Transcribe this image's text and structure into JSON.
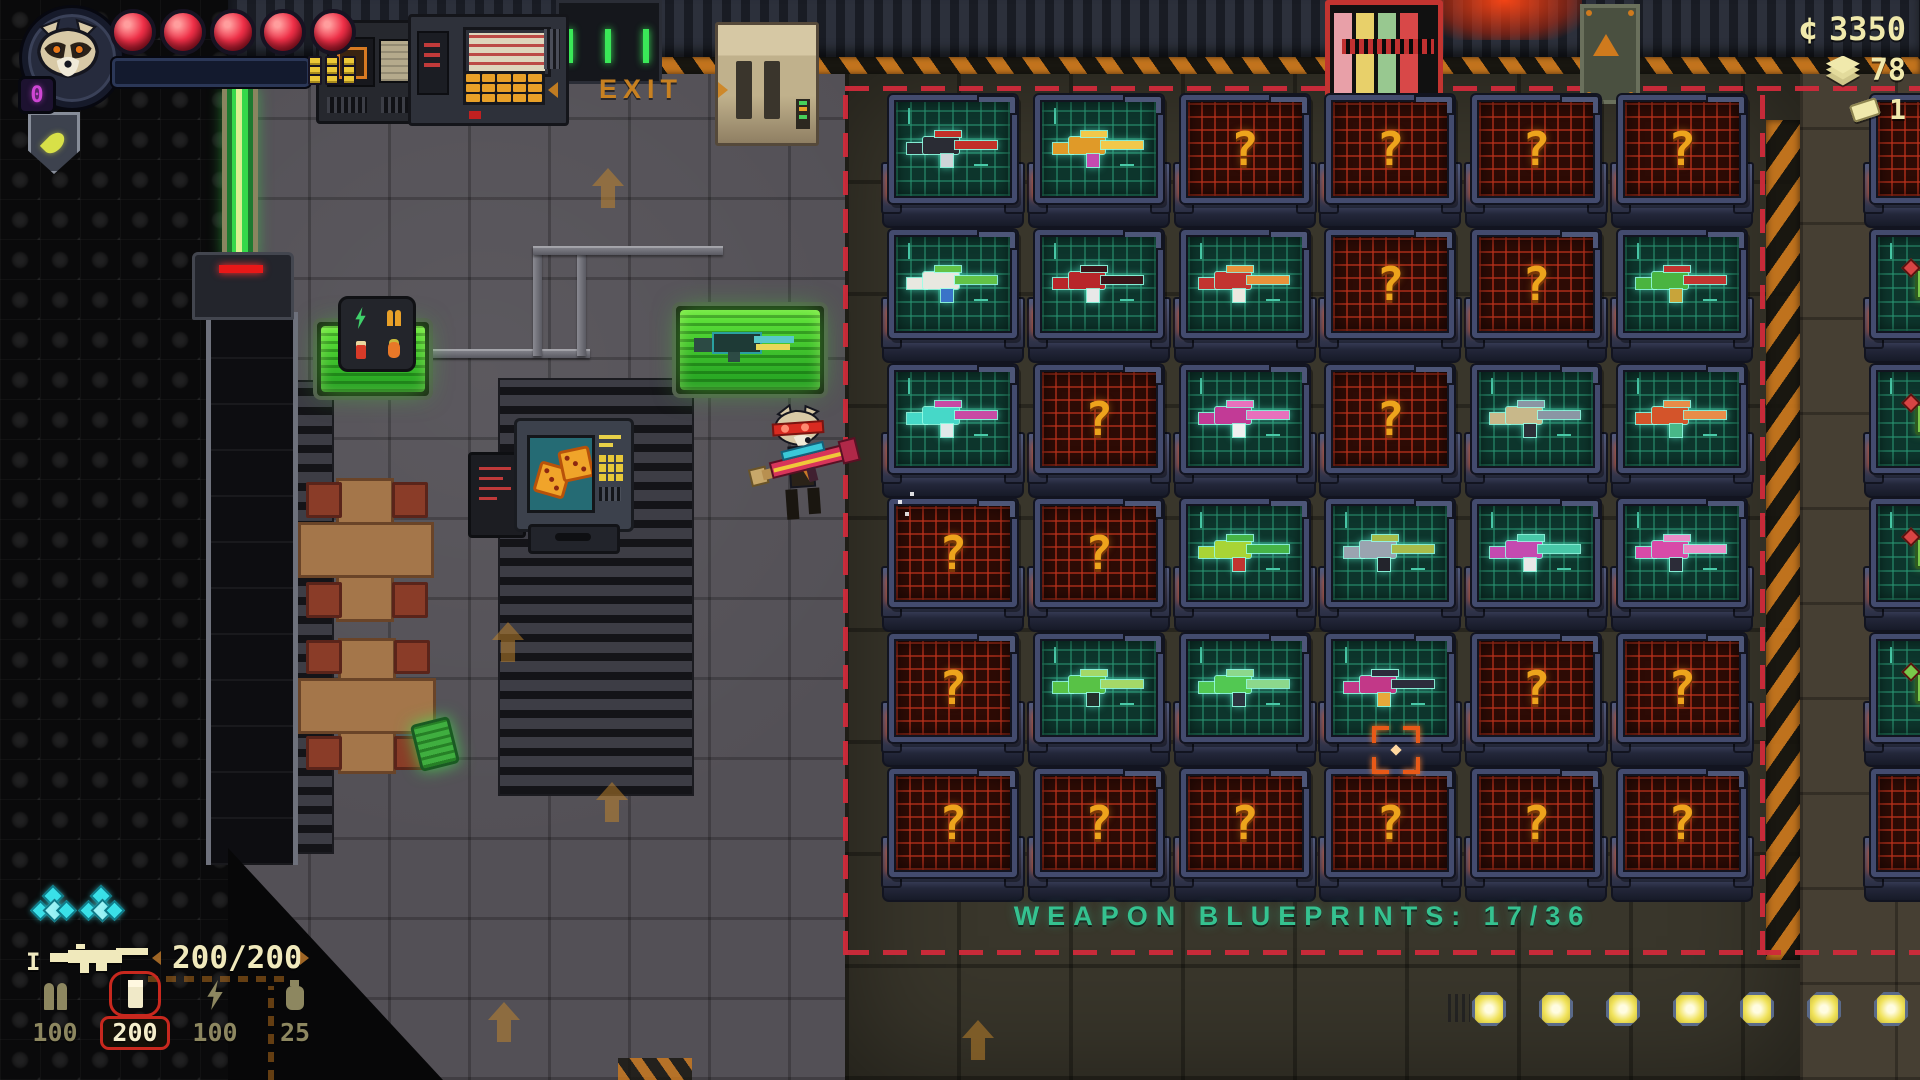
{
  "currencies": [
    {
      "name": "credits",
      "symbol": "¢",
      "value": "3350"
    },
    {
      "name": "materials",
      "value": "78"
    },
    {
      "name": "tickets",
      "value": "1"
    }
  ],
  "hud": {
    "level": "0",
    "health_orbs": 5,
    "xp_segment_columns": 3,
    "gem_count": 2,
    "weapon_tier": "I",
    "ammo": "200/200",
    "ammo_slots": [
      {
        "type": "bullets",
        "value": "100",
        "selected": false
      },
      {
        "type": "shells",
        "value": "200",
        "selected": true
      },
      {
        "type": "energy",
        "value": "100",
        "selected": false
      },
      {
        "type": "gren",
        "value": "25",
        "selected": false
      }
    ]
  },
  "blueprint_room": {
    "caption": "WEAPON BLUEPRINTS: 17/36",
    "unknown_glyph": "?",
    "rows": 6,
    "cols": 6,
    "cells": [
      {
        "state": "known",
        "colors": [
          "#2a2c34",
          "#c23028",
          "#cfd4d8"
        ]
      },
      {
        "state": "known",
        "colors": [
          "#e09a28",
          "#f2c84a",
          "#c44ab0"
        ]
      },
      {
        "state": "unknown"
      },
      {
        "state": "unknown"
      },
      {
        "state": "unknown"
      },
      {
        "state": "unknown"
      },
      {
        "state": "known",
        "colors": [
          "#e8e8e0",
          "#62c246",
          "#3a74c8"
        ]
      },
      {
        "state": "known",
        "colors": [
          "#b8262a",
          "#3a1418",
          "#e8e8e8"
        ]
      },
      {
        "state": "known",
        "colors": [
          "#c23430",
          "#e8913a",
          "#ece8e0"
        ]
      },
      {
        "state": "unknown"
      },
      {
        "state": "unknown"
      },
      {
        "state": "known",
        "colors": [
          "#4ab440",
          "#c23430",
          "#c8a43a"
        ]
      },
      {
        "state": "known",
        "colors": [
          "#46d8c8",
          "#c84aa4",
          "#e0e8e8"
        ]
      },
      {
        "state": "unknown"
      },
      {
        "state": "known",
        "colors": [
          "#c23a96",
          "#e870bc",
          "#efefef"
        ]
      },
      {
        "state": "unknown"
      },
      {
        "state": "known",
        "colors": [
          "#c8b88a",
          "#8a96a4",
          "#2c3038"
        ]
      },
      {
        "state": "known",
        "colors": [
          "#d4542a",
          "#e88c48",
          "#48b888"
        ]
      },
      {
        "state": "unknown"
      },
      {
        "state": "unknown"
      },
      {
        "state": "known",
        "colors": [
          "#a8d435",
          "#46b446",
          "#c23430"
        ]
      },
      {
        "state": "known",
        "colors": [
          "#9aa4b0",
          "#a8bc4a",
          "#23242c"
        ]
      },
      {
        "state": "known",
        "colors": [
          "#c44ab0",
          "#48c8a8",
          "#e8e8e8"
        ]
      },
      {
        "state": "known",
        "colors": [
          "#d84aa8",
          "#ec8cc8",
          "#2c2c38"
        ]
      },
      {
        "state": "unknown"
      },
      {
        "state": "known",
        "colors": [
          "#58c246",
          "#a4d868",
          "#23302c"
        ]
      },
      {
        "state": "known",
        "colors": [
          "#52c852",
          "#8cd88c",
          "#2c3440"
        ]
      },
      {
        "state": "known",
        "colors": [
          "#c23888",
          "#2c2c3c",
          "#e8a83a"
        ]
      },
      {
        "state": "unknown"
      },
      {
        "state": "unknown"
      },
      {
        "state": "unknown"
      },
      {
        "state": "unknown"
      },
      {
        "state": "unknown"
      },
      {
        "state": "unknown"
      },
      {
        "state": "unknown"
      },
      {
        "state": "unknown"
      }
    ],
    "side_cells": [
      {
        "state": "unknown"
      },
      {
        "state": "chip",
        "accent": "#d84444"
      },
      {
        "state": "chip",
        "accent": "#d84444"
      },
      {
        "state": "chip",
        "accent": "#d84444"
      },
      {
        "state": "chip",
        "accent": "#7ac84a"
      },
      {
        "state": "unknown"
      }
    ]
  },
  "world": {
    "exit_label": "EXIT",
    "floor_light_count": 7
  }
}
